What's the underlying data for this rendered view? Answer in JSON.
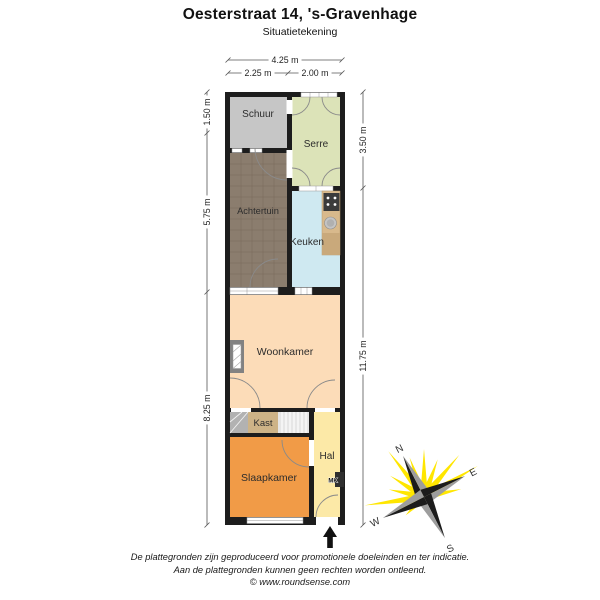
{
  "header": {
    "title": "Oesterstraat 14, 's-Gravenhage",
    "subtitle": "Situatietekening"
  },
  "dimensions": {
    "width_total": "4.25 m",
    "width_left": "2.25 m",
    "width_right": "2.00 m",
    "left_top": "1.50 m",
    "left_middle": "5.75 m",
    "left_bottom": "8.25 m",
    "right_top": "3.50 m",
    "right_bottom": "11.75 m"
  },
  "rooms": {
    "schuur": "Schuur",
    "serre": "Serre",
    "achtertuin": "Achtertuin",
    "keuken": "Keuken",
    "woonkamer": "Woonkamer",
    "kast": "Kast",
    "hal": "Hal",
    "slaapkamer": "Slaapkamer",
    "meterkast": "MK"
  },
  "compass": {
    "north": "N",
    "east": "E",
    "south": "S",
    "west": "W"
  },
  "footer": {
    "disclaimer_line1": "De plattegronden zijn geproduceerd voor promotionele doeleinden en ter indicatie.",
    "disclaimer_line2": "Aan de plattegronden kunnen geen rechten worden ontleend.",
    "credit": "© www.roundsense.com"
  },
  "colors": {
    "wall": "#1d1d1d",
    "schuur": "#c6c6c6",
    "serre": "#dce3b8",
    "achtertuin": "#8b7d6e",
    "keuken": "#cfe9f1",
    "woonkamer": "#fcdcb8",
    "kast": "#cdb387",
    "stairs": "#e6e6e6",
    "slaapkamer": "#f19b47",
    "hal": "#fce9a7",
    "counter": "#d8b98c",
    "compass_ray_yellow": "#ffe600"
  }
}
